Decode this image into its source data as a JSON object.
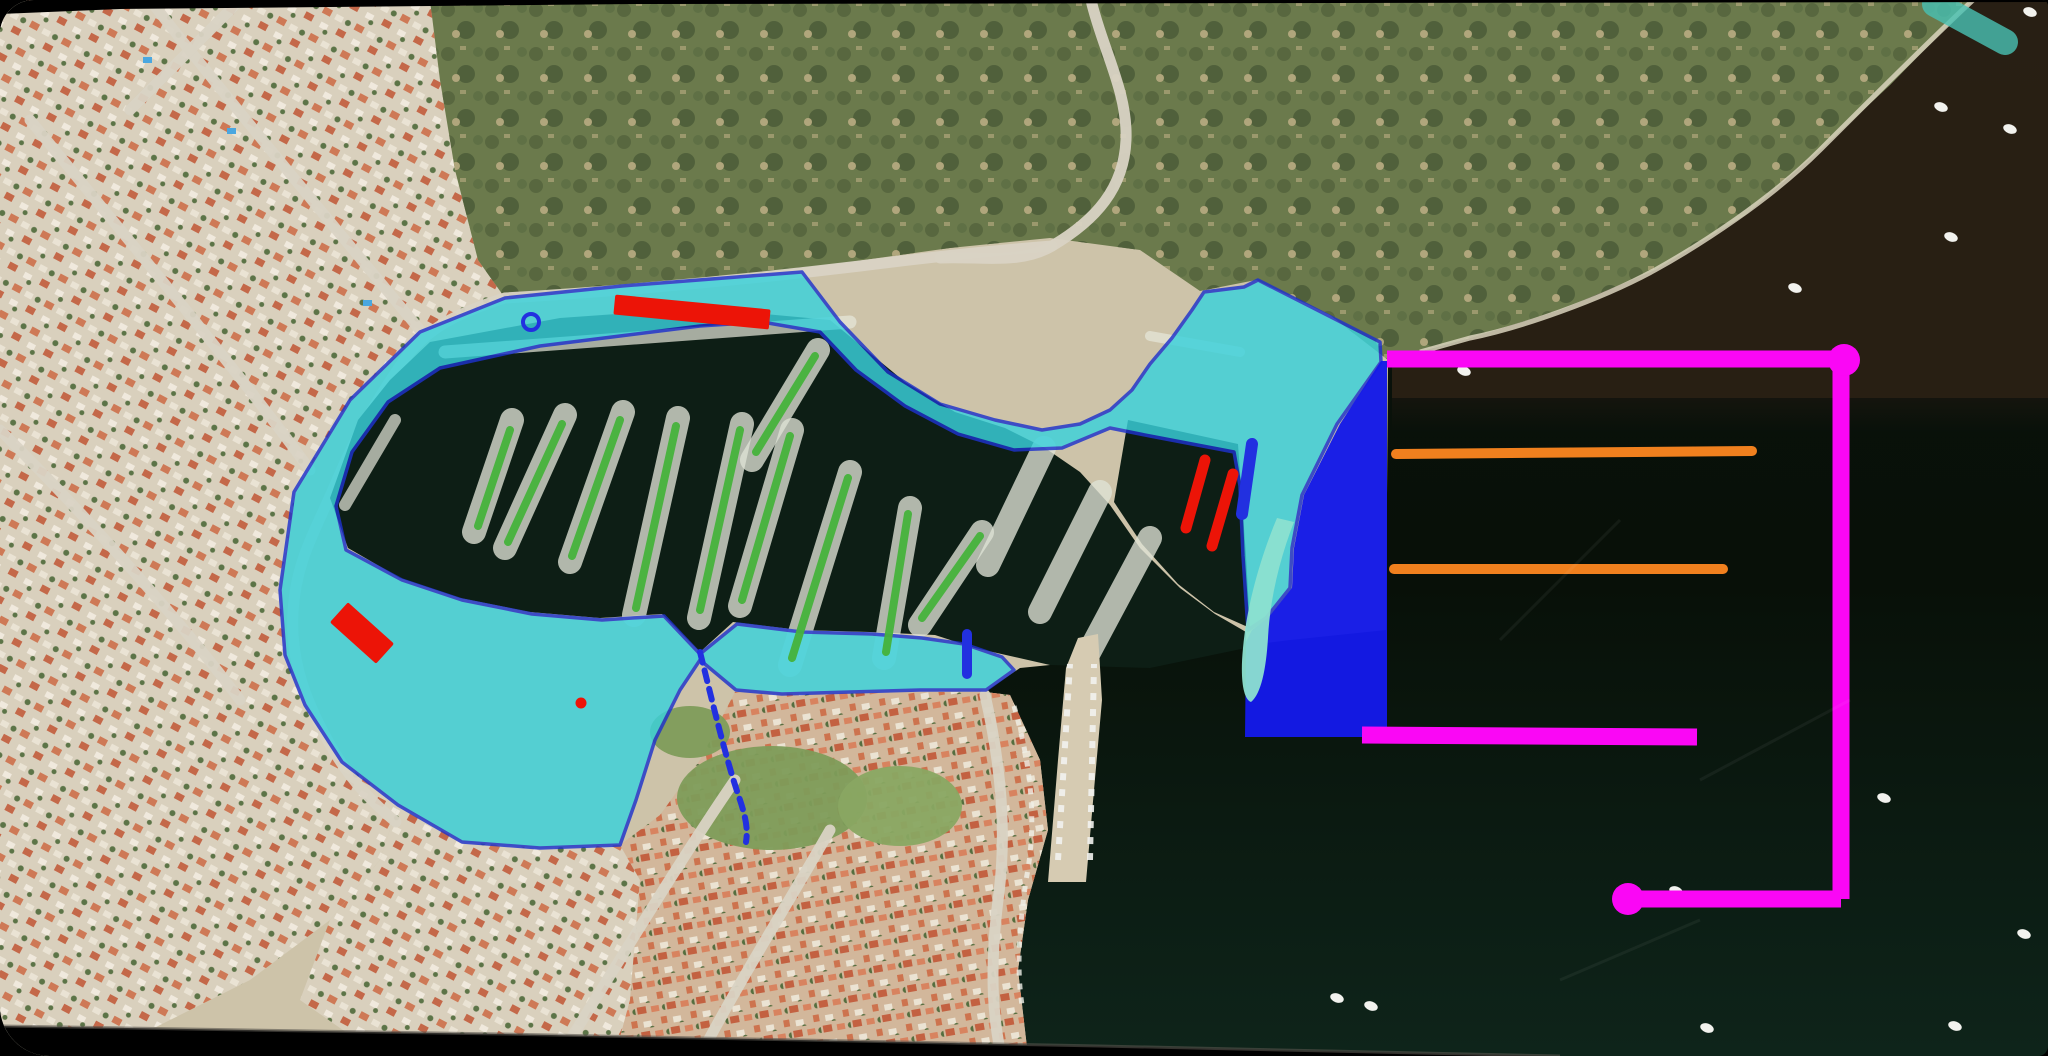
{
  "canvas": {
    "width": 2048,
    "height": 1056,
    "bezel_color": "#000000"
  },
  "palette": {
    "sea_top": "#0b130d",
    "sea_bottom": "#0e241a",
    "murky_water": "#2b2115",
    "murky_fade": "#1c1710",
    "land": "#cdc3a9",
    "road": "#d9d3c4",
    "surf_edge": "#d9d3bd",
    "shallow_teal": "#49c2b4",
    "hill_base": "#6b7a4c",
    "hill_dark1": "#57663e",
    "hill_dark2": "#4f5f3a",
    "hill_dark3": "#5e6f45",
    "hill_tan": "#b4a87e",
    "roof1": "#cd6f4a",
    "roof2": "#c25c3c",
    "roof3": "#d8805c",
    "house_white1": "#ece5d6",
    "house_white2": "#f2ece0",
    "tree": "#4e6a3a",
    "town_base": "#d2b79b",
    "park": "#7e9c5a",
    "park2": "#89a662",
    "basin_water": "#0d1e15",
    "pier_tan": "#d6cbb2",
    "boat_row": "#dfe3d6",
    "boat_white": "#f2f2ee",
    "pool_blue": "#4aa7e0",
    "marina_fill": "#3ad2dc",
    "marina_stroke": "#1e32cc",
    "blue_zone": "#141ae8",
    "cyan_hook": "#8ce0d0",
    "red": "#ec1407",
    "green_line": "#46b33c",
    "orange": "#f0801e",
    "magenta": "#fa07f5",
    "blue_detail": "#2230e0",
    "rim": "#56544c"
  },
  "base": {
    "murky_polygon": [
      [
        1973,
        0
      ],
      [
        2048,
        0
      ],
      [
        2048,
        398
      ],
      [
        1392,
        398
      ],
      [
        1392,
        362
      ],
      [
        1470,
        338
      ],
      [
        1560,
        310
      ],
      [
        1655,
        270
      ],
      [
        1745,
        215
      ],
      [
        1820,
        150
      ],
      [
        1890,
        85
      ]
    ],
    "murky_fade_rect": {
      "x": 1392,
      "y": 398,
      "w": 656,
      "h": 34
    },
    "land_polygon": [
      [
        0,
        0
      ],
      [
        1973,
        0
      ],
      [
        1890,
        85
      ],
      [
        1820,
        150
      ],
      [
        1745,
        215
      ],
      [
        1655,
        270
      ],
      [
        1560,
        310
      ],
      [
        1470,
        338
      ],
      [
        1388,
        360
      ],
      [
        1386,
        630
      ],
      [
        1290,
        640
      ],
      [
        1250,
        645
      ],
      [
        1150,
        655
      ],
      [
        1020,
        668
      ],
      [
        985,
        692
      ],
      [
        1010,
        695
      ],
      [
        1040,
        760
      ],
      [
        1048,
        830
      ],
      [
        1028,
        900
      ],
      [
        1018,
        970
      ],
      [
        1028,
        1056
      ],
      [
        0,
        1056
      ]
    ],
    "hill_polygon": [
      [
        430,
        0
      ],
      [
        1973,
        0
      ],
      [
        1890,
        85
      ],
      [
        1820,
        150
      ],
      [
        1745,
        215
      ],
      [
        1655,
        270
      ],
      [
        1560,
        310
      ],
      [
        1470,
        338
      ],
      [
        1388,
        360
      ],
      [
        1330,
        315
      ],
      [
        1256,
        280
      ],
      [
        1200,
        291
      ],
      [
        1140,
        250
      ],
      [
        1050,
        238
      ],
      [
        950,
        248
      ],
      [
        850,
        262
      ],
      [
        750,
        274
      ],
      [
        640,
        286
      ],
      [
        505,
        298
      ],
      [
        478,
        260
      ],
      [
        455,
        170
      ],
      [
        440,
        80
      ]
    ],
    "coast_edge_path": "M1973,0 C1930,40 1860,110 1820,150 C1770,200 1700,245 1655,270 C1600,300 1520,328 1470,338 L1420,352",
    "shallow_streak_path": "M1935,4 L2005,42",
    "residential_polygons": [
      [
        [
          0,
          0
        ],
        [
          430,
          0
        ],
        [
          440,
          80
        ],
        [
          455,
          170
        ],
        [
          478,
          260
        ],
        [
          505,
          298
        ],
        [
          420,
          332
        ],
        [
          350,
          400
        ],
        [
          296,
          490
        ],
        [
          280,
          590
        ],
        [
          285,
          655
        ],
        [
          305,
          705
        ],
        [
          342,
          762
        ],
        [
          398,
          805
        ],
        [
          380,
          860
        ],
        [
          330,
          920
        ],
        [
          250,
          980
        ],
        [
          150,
          1030
        ],
        [
          60,
          1050
        ],
        [
          0,
          1050
        ]
      ],
      [
        [
          398,
          805
        ],
        [
          462,
          842
        ],
        [
          540,
          848
        ],
        [
          620,
          845
        ],
        [
          640,
          880
        ],
        [
          630,
          1000
        ],
        [
          615,
          1056
        ],
        [
          380,
          1056
        ],
        [
          300,
          1000
        ],
        [
          330,
          920
        ],
        [
          380,
          860
        ]
      ]
    ],
    "town_polygon": [
      [
        615,
        1056
      ],
      [
        630,
        1000
      ],
      [
        640,
        880
      ],
      [
        620,
        845
      ],
      [
        660,
        815
      ],
      [
        700,
        760
      ],
      [
        735,
        692
      ],
      [
        800,
        694
      ],
      [
        920,
        692
      ],
      [
        985,
        692
      ],
      [
        1010,
        695
      ],
      [
        1040,
        760
      ],
      [
        1048,
        830
      ],
      [
        1028,
        900
      ],
      [
        1018,
        970
      ],
      [
        1028,
        1056
      ]
    ],
    "park_blobs": [
      {
        "cx": 772,
        "cy": 798,
        "rx": 95,
        "ry": 52,
        "fill": "park"
      },
      {
        "cx": 900,
        "cy": 806,
        "rx": 62,
        "ry": 40,
        "fill": "park2"
      },
      {
        "cx": 690,
        "cy": 732,
        "rx": 40,
        "ry": 26,
        "fill": "park"
      }
    ],
    "pools": [
      [
        227,
        128
      ],
      [
        363,
        300
      ],
      [
        143,
        57
      ]
    ],
    "roads": [
      "M1091,0 C1102,48 1128,92 1126,140 C1124,188 1096,220 1052,246 C1020,265 980,256 940,258",
      "M1052,246 C1000,250 940,256 860,266 C760,278 640,290 505,298 C460,312 432,326 410,352",
      "M410,352 C378,396 355,438 338,478 C315,532 296,560 293,612 C290,664 308,706 332,748 C352,782 372,802 396,822",
      "M150,0 C220,90 320,210 420,330",
      "M30,120 C120,230 230,360 310,470",
      "M0,430 C90,520 180,620 240,700",
      "M560,1056 C620,960 680,860 735,780",
      "M700,1056 C740,980 790,900 830,830",
      "M985,695 C1000,760 1008,830 998,900 C992,950 990,1000 1000,1050",
      "M240,0 C200,40 160,80 130,110"
    ],
    "basin_polygon": [
      [
        430,
        342
      ],
      [
        560,
        318
      ],
      [
        700,
        308
      ],
      [
        830,
        320
      ],
      [
        905,
        382
      ],
      [
        955,
        412
      ],
      [
        1005,
        428
      ],
      [
        1045,
        448
      ],
      [
        1080,
        472
      ],
      [
        1110,
        505
      ],
      [
        1140,
        548
      ],
      [
        1180,
        588
      ],
      [
        1215,
        614
      ],
      [
        1246,
        632
      ],
      [
        1246,
        648
      ],
      [
        1150,
        668
      ],
      [
        1050,
        665
      ],
      [
        975,
        648
      ],
      [
        935,
        635
      ],
      [
        870,
        632
      ],
      [
        800,
        630
      ],
      [
        733,
        622
      ],
      [
        700,
        652
      ],
      [
        662,
        614
      ],
      [
        600,
        618
      ],
      [
        530,
        612
      ],
      [
        460,
        598
      ],
      [
        400,
        578
      ],
      [
        348,
        548
      ],
      [
        330,
        498
      ],
      [
        358,
        420
      ],
      [
        390,
        380
      ]
    ],
    "pocket_polygon": [
      [
        1128,
        420
      ],
      [
        1238,
        444
      ],
      [
        1246,
        556
      ],
      [
        1250,
        628
      ],
      [
        1214,
        612
      ],
      [
        1178,
        584
      ],
      [
        1142,
        544
      ],
      [
        1114,
        502
      ]
    ],
    "boat_rows": [
      [
        512,
        420,
        474,
        532
      ],
      [
        565,
        415,
        505,
        548
      ],
      [
        623,
        412,
        570,
        562
      ],
      [
        678,
        418,
        634,
        615
      ],
      [
        742,
        424,
        699,
        618
      ],
      [
        792,
        430,
        740,
        606
      ],
      [
        850,
        472,
        790,
        665
      ],
      [
        910,
        508,
        884,
        658
      ],
      [
        982,
        532,
        920,
        625
      ],
      [
        818,
        350,
        752,
        460
      ],
      [
        1044,
        448,
        988,
        565
      ],
      [
        1100,
        492,
        1040,
        612
      ],
      [
        1150,
        538,
        1086,
        658
      ]
    ],
    "quay_boat_bands": [
      {
        "x1": 445,
        "y1": 352,
        "x2": 850,
        "y2": 322,
        "w": 13
      },
      {
        "x1": 345,
        "y1": 505,
        "x2": 395,
        "y2": 420,
        "w": 12
      },
      {
        "x1": 1150,
        "y1": 336,
        "x2": 1240,
        "y2": 352,
        "w": 10
      }
    ],
    "town_pier_polygon": [
      [
        1048,
        882
      ],
      [
        1058,
        760
      ],
      [
        1066,
        668
      ],
      [
        1078,
        638
      ],
      [
        1098,
        634
      ],
      [
        1102,
        700
      ],
      [
        1094,
        790
      ],
      [
        1086,
        882
      ]
    ],
    "pier_boat_dashes": [
      "M1058,860 L1070,664",
      "M1090,860 L1094,664"
    ],
    "shore_boat_dash": "M1014,706 C1030,762 1038,820 1026,880 C1020,925 1016,965 1022,1005",
    "sea_boats": [
      [
        1941,
        107
      ],
      [
        2010,
        129
      ],
      [
        2030,
        12
      ],
      [
        1951,
        237
      ],
      [
        1795,
        288
      ],
      [
        1464,
        371
      ],
      [
        1884,
        798
      ],
      [
        1731,
        896
      ],
      [
        2024,
        934
      ],
      [
        1371,
        1006
      ],
      [
        1707,
        1028
      ],
      [
        1955,
        1026
      ],
      [
        1676,
        891
      ],
      [
        1337,
        998
      ]
    ],
    "scratches": [
      "M1500,640 L1620,520",
      "M1700,780 L1850,700",
      "M1560,980 L1700,920"
    ]
  },
  "annotations": {
    "marina_polygon": {
      "fill_opacity": 0.82,
      "stroke_width": 3.5,
      "points": [
        [
          505,
          298
        ],
        [
          622,
          286
        ],
        [
          750,
          276
        ],
        [
          802,
          272
        ],
        [
          840,
          322
        ],
        [
          888,
          372
        ],
        [
          940,
          404
        ],
        [
          995,
          420
        ],
        [
          1042,
          430
        ],
        [
          1080,
          424
        ],
        [
          1110,
          410
        ],
        [
          1132,
          390
        ],
        [
          1150,
          364
        ],
        [
          1172,
          338
        ],
        [
          1192,
          310
        ],
        [
          1204,
          292
        ],
        [
          1244,
          287
        ],
        [
          1258,
          280
        ],
        [
          1380,
          342
        ],
        [
          1381,
          362
        ],
        [
          1337,
          424
        ],
        [
          1302,
          495
        ],
        [
          1292,
          548
        ],
        [
          1290,
          588
        ],
        [
          1266,
          618
        ],
        [
          1248,
          630
        ],
        [
          1243,
          556
        ],
        [
          1240,
          486
        ],
        [
          1234,
          452
        ],
        [
          1150,
          436
        ],
        [
          1110,
          428
        ],
        [
          1062,
          448
        ],
        [
          1014,
          450
        ],
        [
          958,
          434
        ],
        [
          905,
          406
        ],
        [
          856,
          370
        ],
        [
          820,
          332
        ],
        [
          762,
          322
        ],
        [
          700,
          326
        ],
        [
          620,
          336
        ],
        [
          540,
          346
        ],
        [
          440,
          368
        ],
        [
          388,
          402
        ],
        [
          352,
          452
        ],
        [
          336,
          506
        ],
        [
          346,
          550
        ],
        [
          402,
          580
        ],
        [
          462,
          600
        ],
        [
          532,
          614
        ],
        [
          602,
          620
        ],
        [
          664,
          616
        ],
        [
          700,
          654
        ],
        [
          737,
          624
        ],
        [
          802,
          632
        ],
        [
          872,
          634
        ],
        [
          922,
          638
        ],
        [
          964,
          644
        ],
        [
          1002,
          657
        ],
        [
          1014,
          670
        ],
        [
          986,
          690
        ],
        [
          920,
          690
        ],
        [
          850,
          692
        ],
        [
          782,
          694
        ],
        [
          736,
          690
        ],
        [
          700,
          660
        ],
        [
          680,
          690
        ],
        [
          655,
          740
        ],
        [
          636,
          800
        ],
        [
          620,
          845
        ],
        [
          540,
          848
        ],
        [
          462,
          842
        ],
        [
          398,
          805
        ],
        [
          342,
          762
        ],
        [
          305,
          705
        ],
        [
          285,
          655
        ],
        [
          280,
          590
        ],
        [
          294,
          492
        ],
        [
          350,
          400
        ],
        [
          420,
          332
        ],
        [
          470,
          312
        ]
      ]
    },
    "blue_zone_polygon": [
      [
        1381,
        361
      ],
      [
        1340,
        424
      ],
      [
        1304,
        495
      ],
      [
        1294,
        548
      ],
      [
        1292,
        588
      ],
      [
        1268,
        618
      ],
      [
        1252,
        630
      ],
      [
        1246,
        642
      ],
      [
        1245,
        737
      ],
      [
        1387,
        737
      ],
      [
        1387,
        361
      ]
    ],
    "cyan_hook_path": "M1294,522 C1280,558 1270,598 1268,638 C1266,670 1261,694 1251,702 C1243,699 1240,678 1243,648 C1247,604 1261,556 1277,518 Z",
    "red_bars": [
      {
        "cx": 692,
        "cy": 312,
        "w": 156,
        "h": 20,
        "rot": 5.5
      },
      {
        "cx": 362,
        "cy": 633,
        "w": 62,
        "h": 27,
        "rot": 42
      }
    ],
    "red_ticks": {
      "width": 11,
      "segments": [
        [
          1205,
          460,
          1186,
          528
        ],
        [
          1233,
          474,
          1212,
          546
        ]
      ]
    },
    "red_dot": {
      "cx": 581,
      "cy": 703,
      "r": 5.5
    },
    "green_lines": {
      "width": 8,
      "segments": [
        [
          510,
          430,
          478,
          526
        ],
        [
          562,
          424,
          508,
          542
        ],
        [
          620,
          420,
          572,
          556
        ],
        [
          676,
          426,
          636,
          608
        ],
        [
          740,
          430,
          700,
          610
        ],
        [
          790,
          436,
          742,
          600
        ],
        [
          848,
          478,
          792,
          658
        ],
        [
          908,
          514,
          886,
          652
        ],
        [
          980,
          536,
          922,
          618
        ],
        [
          815,
          356,
          756,
          452
        ]
      ]
    },
    "orange_lines": {
      "width": 10,
      "segments": [
        [
          1396,
          454,
          1752,
          451
        ],
        [
          1394,
          569,
          1723,
          569
        ]
      ]
    },
    "magenta": {
      "width": 17,
      "dot_r": 16,
      "segments": [
        [
          1387,
          359,
          1841,
          359
        ],
        [
          1841,
          359,
          1841,
          899
        ],
        [
          1628,
          899,
          1841,
          899
        ],
        [
          1362,
          735,
          1697,
          737
        ]
      ],
      "dots": [
        [
          1844,
          360
        ],
        [
          1628,
          899
        ]
      ]
    },
    "blue_details": {
      "bar": [
        1252,
        444,
        1242,
        514
      ],
      "bar_w": 12,
      "vbar": [
        967,
        634,
        967,
        674
      ],
      "vbar_w": 10,
      "ring": {
        "cx": 531,
        "cy": 322,
        "r": 8,
        "sw": 4
      },
      "dashed_pier": "M700,652 C712,700 726,760 740,800 C746,818 748,830 746,842"
    }
  },
  "bezels": {
    "top_polygon": [
      [
        0,
        0
      ],
      [
        2048,
        0
      ],
      [
        2048,
        2
      ],
      [
        640,
        4
      ],
      [
        120,
        9
      ],
      [
        0,
        14
      ]
    ],
    "bottom_polygon": [
      [
        0,
        1026
      ],
      [
        500,
        1034
      ],
      [
        1100,
        1046
      ],
      [
        1560,
        1056
      ],
      [
        0,
        1056
      ]
    ],
    "rim_path": "M0,1026 L500,1034 L1100,1046 L1560,1056"
  }
}
